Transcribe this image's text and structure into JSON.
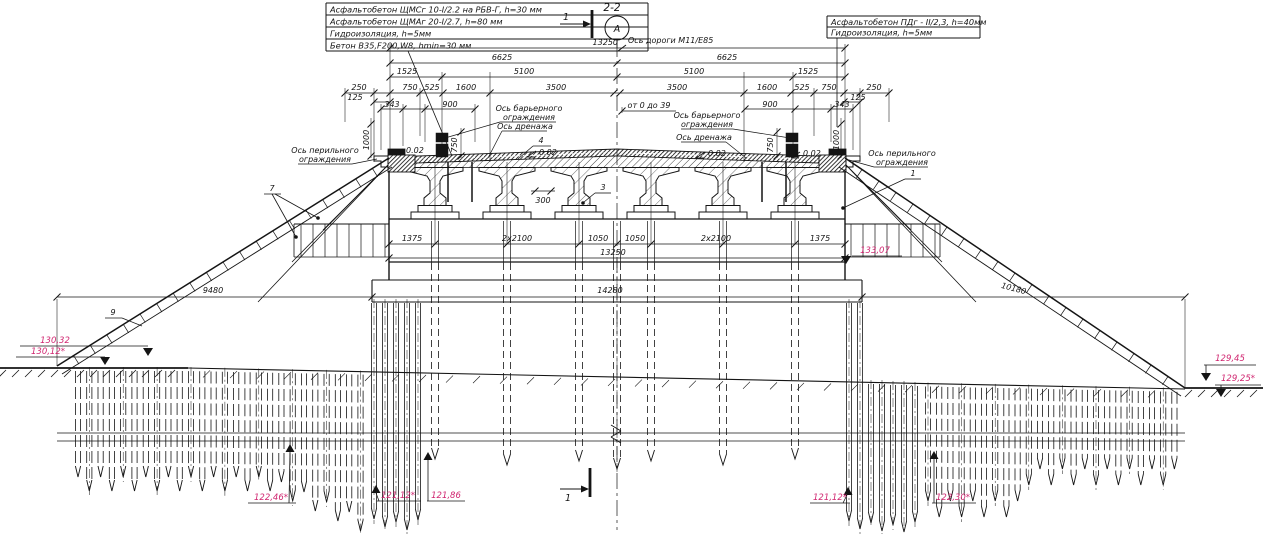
{
  "colors": {
    "line": "#141414",
    "elevation": "#d02670",
    "background": "#ffffff"
  },
  "header": {
    "section_title": "2-2",
    "node_letter": "А",
    "cut_label_top": "1",
    "cut_label_bottom": "1",
    "road_axis": "Ось дороги М11/Е85"
  },
  "spec_left": {
    "r1": "Асфальтобетон ЩМСг 10-I/2.2 на РБВ-Г, h=30 мм",
    "r2": "Асфальтобетон ЩМАг 20-I/2.7, h=80 мм",
    "r3": "Гидроизоляция, h=5мм",
    "r4": "Бетон В35,F200,W8, hmin=30 мм"
  },
  "spec_right": {
    "r1": "Асфальтобетон ПДг - II/2,3, h=40мм",
    "r2": "Гидроизоляция, h=5мм"
  },
  "axes": {
    "barrier1": "Ось барьерного",
    "barrier2": "ограждения",
    "drainage": "Ось дренажа",
    "railing1": "Ось перильного",
    "railing2": "ограждения"
  },
  "dims": {
    "total": "13250",
    "half_l": "6625",
    "half_r": "6625",
    "w1525_l": "1525",
    "w5100_l": "5100",
    "w5100_r": "5100",
    "w1525_r": "1525",
    "w250_l": "250",
    "w125_l": "125",
    "w750_l": "750",
    "w525_l": "525",
    "w1600_l": "1600",
    "w3500_l": "3500",
    "w3500_r": "3500",
    "w1600_r": "1600",
    "w525_r": "525",
    "w750_r": "750",
    "w250_r": "250",
    "w125_r": "125",
    "w343_l": "343",
    "w900_l": "900",
    "w900_r": "900",
    "w343_r": "343",
    "h1000_l": "1000",
    "h1000_r": "1000",
    "h750_l": "750",
    "h750_r": "750",
    "gap300": "300",
    "range": "от 0 до 39",
    "cap1": "1375",
    "cap2": "2x2100",
    "cap3": "1050",
    "cap4": "1050",
    "cap5": "2x2100",
    "cap6": "1375",
    "cap_total": "13250",
    "footing": "14280",
    "slope_l": "9480",
    "slope_r": "10180"
  },
  "slopes": {
    "s1": "0.02",
    "s2": "0.02",
    "s3": "0.02",
    "s4": "0.02"
  },
  "callouts": {
    "k1": "1",
    "k3": "3",
    "k4": "4",
    "k7": "7",
    "k9": "9"
  },
  "elevations": {
    "emb_top_l": "130,32",
    "ground_l": "130,12*",
    "cap_r": "133,07",
    "emb_top_r": "129,45",
    "ground_r": "129,25*",
    "pile_l_outer": "122,46*",
    "pile_l_mid": "121,12*",
    "pile_l_inner": "121,86",
    "pile_r_inner": "121,12*",
    "pile_r_outer": "122,30*"
  }
}
